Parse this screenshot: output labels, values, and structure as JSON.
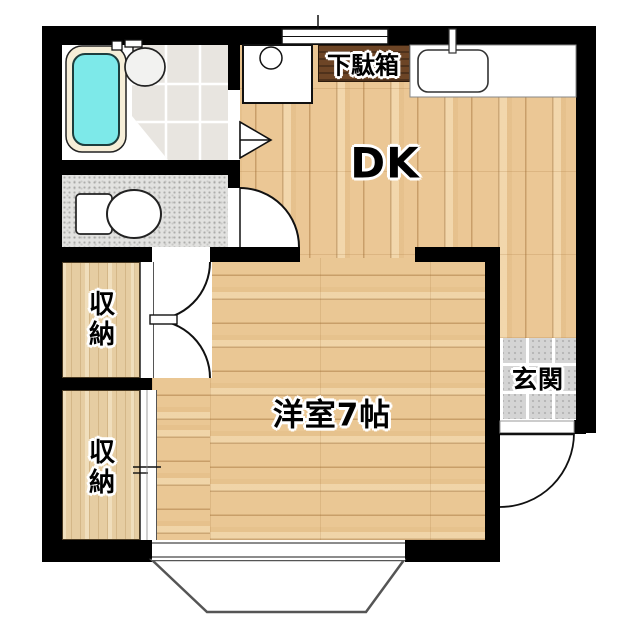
{
  "floorplan": {
    "type": "japanese-apartment-1dk",
    "rooms": {
      "dk": {
        "label": "DK"
      },
      "western_room": {
        "label": "洋室7帖"
      },
      "storage_upper": {
        "label": "収納"
      },
      "storage_lower": {
        "label": "収納"
      },
      "entrance": {
        "label": "玄関"
      },
      "shoe_cabinet": {
        "label": "下駄箱"
      }
    },
    "fixtures": [
      "bathtub",
      "washbasin",
      "toilet",
      "kitchen-sink",
      "washing-machine-pan",
      "folding-door",
      "swing-door",
      "double-closet-doors",
      "sliding-closet-door",
      "entrance-door",
      "window-top",
      "bay-window-bottom"
    ],
    "colors": {
      "wall": "#000000",
      "wood_floor": "#ebc795",
      "closet_floor": "#e6cda2",
      "shoe_cabinet": "#6d4526",
      "bath_water": "#7de9e9",
      "entrance_tile": "#d4d4d4",
      "washroom_tile": "#e8e5e0",
      "toilet_floor": "#e2e2e0",
      "background": "#ffffff"
    }
  }
}
